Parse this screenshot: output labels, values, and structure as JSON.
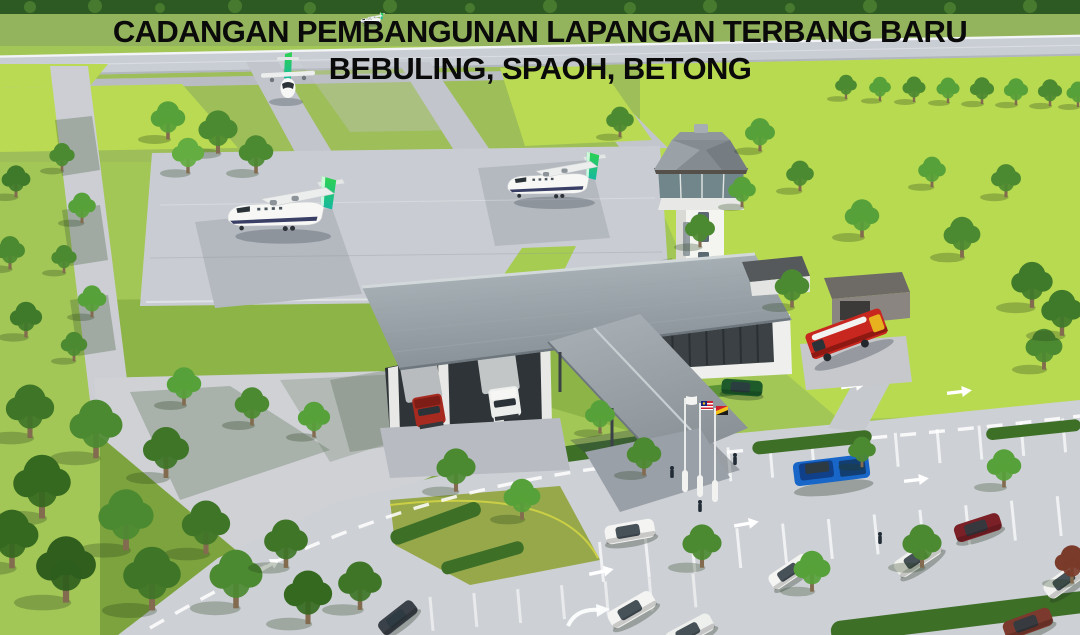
{
  "title": {
    "line1": "CADANGAN PEMBANGUNAN LAPANGAN TERBANG BARU",
    "line2": "BEBULING, SPAOH, BETONG"
  },
  "scene": {
    "type": "3d-architectural-rendering",
    "subject": "proposed new airport",
    "features": [
      "runway with parallel taxiway",
      "two diagonal taxiway links",
      "aircraft apron with two parking stands",
      "two parked turboprop aircraft with green tails",
      "one aircraft taxiing toward apron",
      "one distant aircraft on runway",
      "air traffic control tower",
      "terminal building with cargo bays and louvred wall",
      "two box trucks at cargo bays",
      "covered walkway canopy to car park",
      "three flag poles at entrance",
      "fire station with fire engine",
      "access road loop with car park",
      "parked cars and pickup truck",
      "landscaped lawns, hedges and trees"
    ],
    "aircraft": {
      "on_apron": 2,
      "taxiing": 1,
      "on_runway": 1
    },
    "flags": [
      "white",
      "malaysia",
      "sarawak"
    ]
  },
  "palette": {
    "title_text": "#0a0a0a",
    "bright_field_green": "#b8da51",
    "lawn_green": "#8db447",
    "forest_green": "#2d5a23",
    "pavement_grey": "#cdd0d5",
    "apron_grey": "#c9cdd3",
    "roof_grey": "#98a1a7",
    "aircraft_tail_green": "#2fd24f",
    "aircraft_tail_teal": "#14b8a0",
    "fire_truck_red": "#c8271f",
    "pickup_blue": "#1766c8",
    "suv_dark_red": "#7a2026",
    "car_dark_green": "#1d5c2a",
    "marking_white": "#ffffff"
  }
}
